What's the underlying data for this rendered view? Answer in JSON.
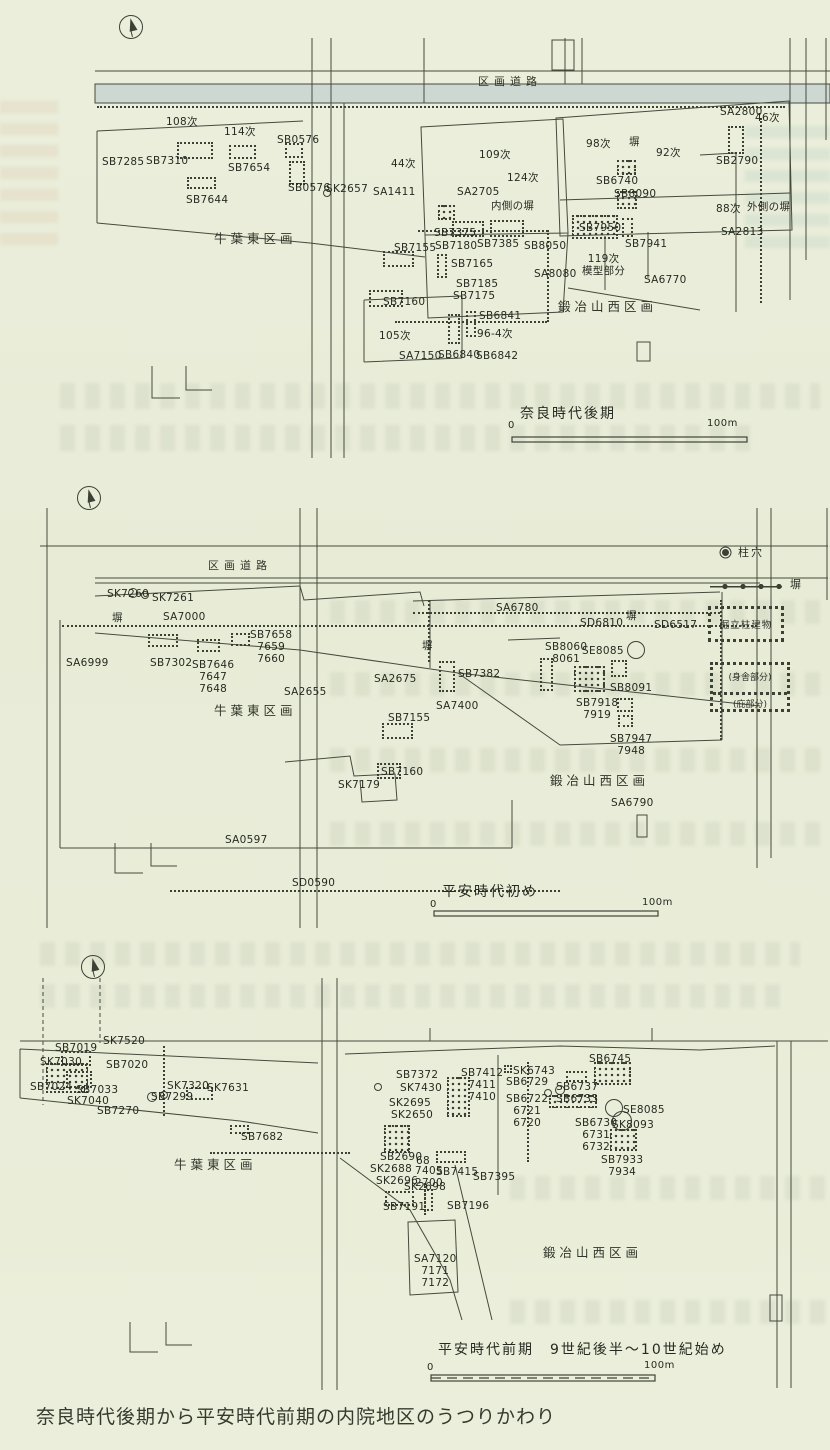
{
  "page": {
    "caption": "奈良時代後期から平安時代前期の内院地区のうつりかわり"
  },
  "legend": {
    "posthole": "柱穴",
    "fence": "塀",
    "building": "掘立柱建物",
    "moya": "(身舎部分)",
    "hisashi": "(庇部分)"
  },
  "panels": [
    {
      "key": "nara-late",
      "period": "奈良時代後期",
      "labels": [
        {
          "t": "区画道路",
          "x": 478,
          "y": 76,
          "cls": "road"
        },
        {
          "t": "108次",
          "x": 166,
          "y": 116
        },
        {
          "t": "114次",
          "x": 224,
          "y": 126
        },
        {
          "t": "SB0576",
          "x": 277,
          "y": 134
        },
        {
          "t": "SB7285",
          "x": 102,
          "y": 156
        },
        {
          "t": "SB7310",
          "x": 146,
          "y": 155
        },
        {
          "t": "SB7654",
          "x": 228,
          "y": 162
        },
        {
          "t": "SB0576",
          "x": 288,
          "y": 182
        },
        {
          "t": "SK2657",
          "x": 326,
          "y": 183
        },
        {
          "t": "SB7644",
          "x": 186,
          "y": 194
        },
        {
          "t": "SA1411",
          "x": 373,
          "y": 186
        },
        {
          "t": "44次",
          "x": 391,
          "y": 158
        },
        {
          "t": "109次",
          "x": 479,
          "y": 149
        },
        {
          "t": "124次",
          "x": 507,
          "y": 172
        },
        {
          "t": "SA2705",
          "x": 457,
          "y": 186
        },
        {
          "t": "内側の塀",
          "x": 491,
          "y": 200
        },
        {
          "t": "98次",
          "x": 586,
          "y": 138
        },
        {
          "t": "塀",
          "x": 629,
          "y": 136
        },
        {
          "t": "92次",
          "x": 656,
          "y": 147
        },
        {
          "t": "SA2800",
          "x": 720,
          "y": 106
        },
        {
          "t": "46次",
          "x": 755,
          "y": 112
        },
        {
          "t": "SB2790",
          "x": 716,
          "y": 155
        },
        {
          "t": "SB6740",
          "x": 596,
          "y": 175
        },
        {
          "t": "SB8090",
          "x": 614,
          "y": 188
        },
        {
          "t": "88次",
          "x": 716,
          "y": 203
        },
        {
          "t": "外側の塀",
          "x": 747,
          "y": 201
        },
        {
          "t": "SA2813",
          "x": 721,
          "y": 226
        },
        {
          "t": "SB7375",
          "x": 434,
          "y": 227
        },
        {
          "t": "SB7180",
          "x": 435,
          "y": 240
        },
        {
          "t": "SB7385",
          "x": 477,
          "y": 238
        },
        {
          "t": "SB8050",
          "x": 524,
          "y": 240
        },
        {
          "t": "SB7950",
          "x": 579,
          "y": 222
        },
        {
          "t": "SB7941",
          "x": 625,
          "y": 238
        },
        {
          "t": "SB7155",
          "x": 394,
          "y": 242
        },
        {
          "t": "SB7165",
          "x": 451,
          "y": 258
        },
        {
          "t": "SA8080",
          "x": 534,
          "y": 268
        },
        {
          "t": "119次\n模型部分",
          "x": 582,
          "y": 253
        },
        {
          "t": "SA6770",
          "x": 644,
          "y": 274
        },
        {
          "t": "SB7185",
          "x": 456,
          "y": 278
        },
        {
          "t": "SB7175",
          "x": 453,
          "y": 290
        },
        {
          "t": "SB7160",
          "x": 383,
          "y": 296
        },
        {
          "t": "105次",
          "x": 379,
          "y": 330
        },
        {
          "t": "SA7150",
          "x": 399,
          "y": 350
        },
        {
          "t": "SB6840",
          "x": 438,
          "y": 349
        },
        {
          "t": "SB6841",
          "x": 479,
          "y": 310
        },
        {
          "t": "96-4次",
          "x": 477,
          "y": 328
        },
        {
          "t": "SB6842",
          "x": 476,
          "y": 350
        },
        {
          "t": "鍛冶山西区画",
          "x": 558,
          "y": 300,
          "cls": "region"
        },
        {
          "t": "牛葉東区画",
          "x": 214,
          "y": 232,
          "cls": "region"
        },
        {
          "t": "奈良時代後期",
          "x": 520,
          "y": 406,
          "cls": "period"
        },
        {
          "t": "0",
          "x": 508,
          "y": 420,
          "cls": "scale"
        },
        {
          "t": "100m",
          "x": 707,
          "y": 418,
          "cls": "scale"
        }
      ],
      "buildings": [
        {
          "x": 177,
          "y": 142,
          "w": 36,
          "h": 17,
          "s": "d"
        },
        {
          "x": 229,
          "y": 145,
          "w": 27,
          "h": 14,
          "s": "d"
        },
        {
          "x": 285,
          "y": 143,
          "w": 18,
          "h": 15,
          "s": "d"
        },
        {
          "x": 289,
          "y": 161,
          "w": 16,
          "h": 24,
          "s": "d"
        },
        {
          "x": 187,
          "y": 177,
          "w": 29,
          "h": 12,
          "s": "d"
        },
        {
          "x": 438,
          "y": 205,
          "w": 17,
          "h": 15,
          "s": "g"
        },
        {
          "x": 452,
          "y": 221,
          "w": 32,
          "h": 16,
          "s": "d"
        },
        {
          "x": 490,
          "y": 220,
          "w": 34,
          "h": 17,
          "s": "d"
        },
        {
          "x": 572,
          "y": 215,
          "w": 46,
          "h": 24,
          "s": "g"
        },
        {
          "x": 622,
          "y": 218,
          "w": 11,
          "h": 19,
          "s": "d"
        },
        {
          "x": 617,
          "y": 160,
          "w": 19,
          "h": 15,
          "s": "g"
        },
        {
          "x": 617,
          "y": 191,
          "w": 20,
          "h": 18,
          "s": "g"
        },
        {
          "x": 383,
          "y": 251,
          "w": 31,
          "h": 16,
          "s": "d"
        },
        {
          "x": 437,
          "y": 254,
          "w": 10,
          "h": 24,
          "s": "d"
        },
        {
          "x": 369,
          "y": 290,
          "w": 34,
          "h": 17,
          "s": "d"
        },
        {
          "x": 728,
          "y": 126,
          "w": 16,
          "h": 28,
          "s": "d"
        },
        {
          "x": 448,
          "y": 314,
          "w": 12,
          "h": 30,
          "s": "d"
        },
        {
          "x": 466,
          "y": 311,
          "w": 10,
          "h": 26,
          "s": "d"
        }
      ],
      "fences": [
        {
          "x": 97,
          "y": 106,
          "len": 688,
          "dir": "h"
        },
        {
          "x": 418,
          "y": 230,
          "len": 130,
          "dir": "h"
        },
        {
          "x": 547,
          "y": 230,
          "len": 92,
          "dir": "v"
        },
        {
          "x": 395,
          "y": 321,
          "len": 152,
          "dir": "h"
        },
        {
          "x": 760,
          "y": 118,
          "len": 185,
          "dir": "v"
        }
      ],
      "circles": [
        {
          "x": 327,
          "y": 193,
          "r": 4
        }
      ]
    },
    {
      "key": "heian-early",
      "period": "平安時代初め",
      "labels": [
        {
          "t": "区画道路",
          "x": 208,
          "y": 560,
          "cls": "road"
        },
        {
          "t": "SK7260",
          "x": 107,
          "y": 588
        },
        {
          "t": "SK7261",
          "x": 152,
          "y": 592
        },
        {
          "t": "塀",
          "x": 112,
          "y": 612
        },
        {
          "t": "SA7000",
          "x": 163,
          "y": 611
        },
        {
          "t": "SB7658\n7659\n7660",
          "x": 250,
          "y": 629
        },
        {
          "t": "SB7302",
          "x": 150,
          "y": 657
        },
        {
          "t": "SB7646\n7647\n7648",
          "x": 192,
          "y": 659
        },
        {
          "t": "SA6999",
          "x": 66,
          "y": 657
        },
        {
          "t": "SA2655",
          "x": 284,
          "y": 686
        },
        {
          "t": "牛葉東区画",
          "x": 214,
          "y": 704,
          "cls": "region"
        },
        {
          "t": "SA2675",
          "x": 374,
          "y": 673
        },
        {
          "t": "塀",
          "x": 422,
          "y": 640
        },
        {
          "t": "SB7382",
          "x": 458,
          "y": 668
        },
        {
          "t": "SA7400",
          "x": 436,
          "y": 700
        },
        {
          "t": "SB7155",
          "x": 388,
          "y": 712
        },
        {
          "t": "SA6780",
          "x": 496,
          "y": 602
        },
        {
          "t": "SD6810",
          "x": 580,
          "y": 617
        },
        {
          "t": "塀",
          "x": 626,
          "y": 610
        },
        {
          "t": "SD6517",
          "x": 654,
          "y": 619
        },
        {
          "t": "SB8060\n8061",
          "x": 545,
          "y": 641
        },
        {
          "t": "SE8085",
          "x": 582,
          "y": 645
        },
        {
          "t": "SB8091",
          "x": 610,
          "y": 682
        },
        {
          "t": "SB7918\n7919",
          "x": 576,
          "y": 697
        },
        {
          "t": "SB7947\n7948",
          "x": 610,
          "y": 733
        },
        {
          "t": "SB7160",
          "x": 381,
          "y": 766
        },
        {
          "t": "SK7179",
          "x": 338,
          "y": 779
        },
        {
          "t": "鍛冶山西区画",
          "x": 550,
          "y": 774,
          "cls": "region"
        },
        {
          "t": "SA6790",
          "x": 611,
          "y": 797
        },
        {
          "t": "SA0597",
          "x": 225,
          "y": 834
        },
        {
          "t": "SD0590",
          "x": 292,
          "y": 877
        },
        {
          "t": "平安時代初め",
          "x": 442,
          "y": 884,
          "cls": "period"
        },
        {
          "t": "0",
          "x": 430,
          "y": 899,
          "cls": "scale"
        },
        {
          "t": "100m",
          "x": 642,
          "y": 897,
          "cls": "scale"
        }
      ],
      "buildings": [
        {
          "x": 148,
          "y": 634,
          "w": 30,
          "h": 13,
          "s": "d"
        },
        {
          "x": 197,
          "y": 639,
          "w": 23,
          "h": 13,
          "s": "d"
        },
        {
          "x": 231,
          "y": 633,
          "w": 19,
          "h": 13,
          "s": "d"
        },
        {
          "x": 439,
          "y": 661,
          "w": 16,
          "h": 31,
          "s": "d"
        },
        {
          "x": 382,
          "y": 723,
          "w": 31,
          "h": 16,
          "s": "d"
        },
        {
          "x": 377,
          "y": 763,
          "w": 24,
          "h": 16,
          "s": "d"
        },
        {
          "x": 540,
          "y": 658,
          "w": 13,
          "h": 33,
          "s": "d"
        },
        {
          "x": 574,
          "y": 666,
          "w": 31,
          "h": 26,
          "s": "g"
        },
        {
          "x": 611,
          "y": 660,
          "w": 16,
          "h": 17,
          "s": "d"
        },
        {
          "x": 617,
          "y": 698,
          "w": 16,
          "h": 14,
          "s": "d"
        },
        {
          "x": 618,
          "y": 715,
          "w": 15,
          "h": 12,
          "s": "d"
        }
      ],
      "fences": [
        {
          "x": 62,
          "y": 625,
          "len": 695,
          "dir": "h"
        },
        {
          "x": 413,
          "y": 612,
          "len": 307,
          "dir": "h"
        },
        {
          "x": 720,
          "y": 600,
          "len": 140,
          "dir": "v"
        },
        {
          "x": 428,
          "y": 600,
          "len": 62,
          "dir": "v"
        },
        {
          "x": 170,
          "y": 890,
          "len": 390,
          "dir": "h"
        }
      ],
      "circles": [
        {
          "x": 133,
          "y": 593,
          "r": 5
        },
        {
          "x": 145,
          "y": 595,
          "r": 4
        },
        {
          "x": 636,
          "y": 650,
          "r": 9
        }
      ]
    },
    {
      "key": "heian-early-period",
      "period": "平安時代前期　9世紀後半～10世紀始め",
      "labels": [
        {
          "t": "SK7520",
          "x": 103,
          "y": 1035
        },
        {
          "t": "SB7019",
          "x": 55,
          "y": 1042
        },
        {
          "t": "SK7030",
          "x": 40,
          "y": 1056
        },
        {
          "t": "SB7020",
          "x": 106,
          "y": 1059
        },
        {
          "t": "SB7024",
          "x": 30,
          "y": 1081
        },
        {
          "t": "SB7033",
          "x": 76,
          "y": 1084
        },
        {
          "t": "SK7040",
          "x": 67,
          "y": 1095
        },
        {
          "t": "SB7270",
          "x": 97,
          "y": 1105
        },
        {
          "t": "SK7320",
          "x": 167,
          "y": 1080
        },
        {
          "t": "SB7299",
          "x": 151,
          "y": 1091
        },
        {
          "t": "SK7631",
          "x": 207,
          "y": 1082
        },
        {
          "t": "SB7682",
          "x": 241,
          "y": 1131
        },
        {
          "t": "牛葉東区画",
          "x": 174,
          "y": 1158,
          "cls": "region"
        },
        {
          "t": "SB7372",
          "x": 396,
          "y": 1069
        },
        {
          "t": "SK7430",
          "x": 400,
          "y": 1082
        },
        {
          "t": "SB7412\n7411\n7410",
          "x": 461,
          "y": 1067
        },
        {
          "t": "SK2695",
          "x": 389,
          "y": 1097
        },
        {
          "t": "SK2650",
          "x": 391,
          "y": 1109
        },
        {
          "t": "SK6743",
          "x": 513,
          "y": 1065
        },
        {
          "t": "SB6729",
          "x": 506,
          "y": 1076
        },
        {
          "t": "SB6722\n6721\n6720",
          "x": 506,
          "y": 1093
        },
        {
          "t": "SB6745",
          "x": 589,
          "y": 1053
        },
        {
          "t": "SB6737",
          "x": 556,
          "y": 1081
        },
        {
          "t": "SB6733",
          "x": 556,
          "y": 1093
        },
        {
          "t": "SE8085",
          "x": 623,
          "y": 1104
        },
        {
          "t": "SB6730\n6731\n6732",
          "x": 575,
          "y": 1117
        },
        {
          "t": "SK8093",
          "x": 612,
          "y": 1119
        },
        {
          "t": "SB7933\n7934",
          "x": 601,
          "y": 1154
        },
        {
          "t": "SB2690",
          "x": 380,
          "y": 1151
        },
        {
          "t": "68",
          "x": 416,
          "y": 1155
        },
        {
          "t": "SK2688",
          "x": 370,
          "y": 1163
        },
        {
          "t": "7405\n2700",
          "x": 415,
          "y": 1165
        },
        {
          "t": "SK2696",
          "x": 376,
          "y": 1175
        },
        {
          "t": "SK2698",
          "x": 404,
          "y": 1181
        },
        {
          "t": "SB7415",
          "x": 436,
          "y": 1166
        },
        {
          "t": "SB7395",
          "x": 473,
          "y": 1171
        },
        {
          "t": "SB7191",
          "x": 383,
          "y": 1201
        },
        {
          "t": "SB7196",
          "x": 447,
          "y": 1200
        },
        {
          "t": "SA7120\n7171\n7172",
          "x": 414,
          "y": 1253
        },
        {
          "t": "鍛冶山西区画",
          "x": 543,
          "y": 1246,
          "cls": "region"
        },
        {
          "t": "平安時代前期　9世紀後半～10世紀始め",
          "x": 438,
          "y": 1342,
          "cls": "period"
        },
        {
          "t": "0",
          "x": 427,
          "y": 1362,
          "cls": "scale"
        },
        {
          "t": "100m",
          "x": 644,
          "y": 1360,
          "cls": "scale"
        }
      ],
      "buildings": [
        {
          "x": 61,
          "y": 1051,
          "w": 30,
          "h": 15,
          "s": "d"
        },
        {
          "x": 46,
          "y": 1063,
          "w": 42,
          "h": 30,
          "s": "g"
        },
        {
          "x": 66,
          "y": 1071,
          "w": 26,
          "h": 17,
          "s": "d"
        },
        {
          "x": 186,
          "y": 1087,
          "w": 27,
          "h": 13,
          "s": "d"
        },
        {
          "x": 230,
          "y": 1125,
          "w": 19,
          "h": 9,
          "s": "d"
        },
        {
          "x": 447,
          "y": 1077,
          "w": 23,
          "h": 40,
          "s": "g"
        },
        {
          "x": 384,
          "y": 1125,
          "w": 26,
          "h": 28,
          "s": "g"
        },
        {
          "x": 385,
          "y": 1191,
          "w": 29,
          "h": 15,
          "s": "d"
        },
        {
          "x": 424,
          "y": 1189,
          "w": 9,
          "h": 22,
          "s": "d"
        },
        {
          "x": 436,
          "y": 1151,
          "w": 30,
          "h": 12,
          "s": "d"
        },
        {
          "x": 594,
          "y": 1062,
          "w": 37,
          "h": 23,
          "s": "g"
        },
        {
          "x": 566,
          "y": 1071,
          "w": 21,
          "h": 11,
          "s": "d"
        },
        {
          "x": 549,
          "y": 1095,
          "w": 48,
          "h": 13,
          "s": "g"
        },
        {
          "x": 610,
          "y": 1129,
          "w": 27,
          "h": 22,
          "s": "g"
        },
        {
          "x": 504,
          "y": 1065,
          "w": 8,
          "h": 8,
          "s": "d"
        }
      ],
      "fences": [
        {
          "x": 163,
          "y": 1046,
          "len": 70,
          "dir": "v"
        },
        {
          "x": 527,
          "y": 1062,
          "len": 100,
          "dir": "v"
        },
        {
          "x": 424,
          "y": 1183,
          "len": 32,
          "dir": "v"
        },
        {
          "x": 210,
          "y": 1152,
          "len": 140,
          "dir": "h"
        }
      ],
      "circles": [
        {
          "x": 152,
          "y": 1097,
          "r": 5
        },
        {
          "x": 164,
          "y": 1095,
          "r": 4
        },
        {
          "x": 614,
          "y": 1108,
          "r": 9
        },
        {
          "x": 622,
          "y": 1121,
          "r": 10
        },
        {
          "x": 560,
          "y": 1090,
          "r": 5
        },
        {
          "x": 548,
          "y": 1093,
          "r": 4
        },
        {
          "x": 378,
          "y": 1087,
          "r": 4
        }
      ]
    }
  ]
}
